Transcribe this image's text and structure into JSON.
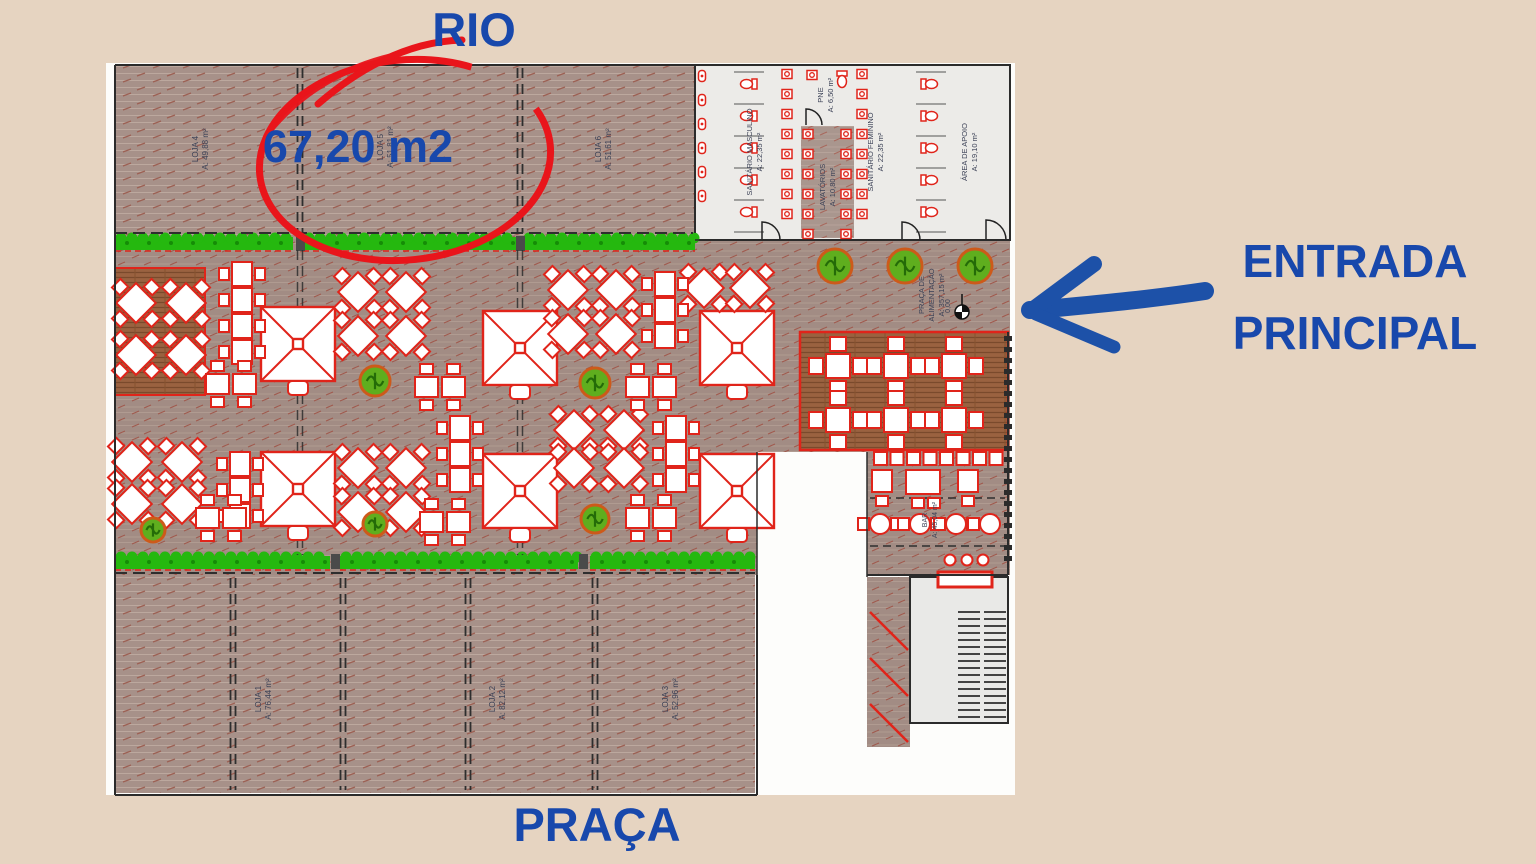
{
  "colors": {
    "background": "#e6d4c1",
    "annotation_blue": "#1848ac",
    "marker_red": "#e9151b",
    "furniture_red": "#e0241a",
    "hedge_green": "#25b80f",
    "wall": "#2b2b2b"
  },
  "annotations": {
    "rio": "RIO",
    "area_value": "67,20 m2",
    "entrada_line1": "ENTRADA",
    "entrada_line2": "PRINCIPAL",
    "praca": "PRAÇA"
  },
  "plan": {
    "areas": [
      {
        "id": "loja4",
        "lines": [
          "LOJA 4",
          "A: 49,88 m²"
        ],
        "x": 203,
        "y": 149,
        "fs": 8
      },
      {
        "id": "loja5",
        "lines": [
          "LOJA 5",
          "A: 51,81 m²"
        ],
        "x": 388,
        "y": 147,
        "fs": 8
      },
      {
        "id": "loja6",
        "lines": [
          "LOJA 6",
          "A: 51,61 m²"
        ],
        "x": 606,
        "y": 149,
        "fs": 8
      },
      {
        "id": "loja1",
        "lines": [
          "LOJA 1",
          "A: 76,44 m²"
        ],
        "x": 266,
        "y": 699,
        "fs": 8
      },
      {
        "id": "loja2",
        "lines": [
          "LOJA 2",
          "A: 82,12 m²"
        ],
        "x": 500,
        "y": 699,
        "fs": 8
      },
      {
        "id": "loja3",
        "lines": [
          "LOJA 3",
          "A: 52,96 m²"
        ],
        "x": 673,
        "y": 699,
        "fs": 8
      },
      {
        "id": "sanitario-masculino",
        "lines": [
          "SANITÁRIO MASCULINO",
          "A: 22,35 m²"
        ],
        "x": 757,
        "y": 152,
        "fs": 7.5
      },
      {
        "id": "pne",
        "lines": [
          "PNE",
          "A: 6,50 m²"
        ],
        "x": 828,
        "y": 95,
        "fs": 7.5
      },
      {
        "id": "lavatorios",
        "lines": [
          "LAVATÓRIOS",
          "A: 10,80 m²"
        ],
        "x": 830,
        "y": 187,
        "fs": 7.5
      },
      {
        "id": "sanitario-feminino",
        "lines": [
          "SANITÁRIO FEMININO",
          "A: 22,35 m²"
        ],
        "x": 878,
        "y": 152,
        "fs": 7.5
      },
      {
        "id": "area-de-apoio",
        "lines": [
          "ÁREA DE APOIO",
          "A: 19,10 m²"
        ],
        "x": 972,
        "y": 152,
        "fs": 7.5
      },
      {
        "id": "praca-alimentacao",
        "lines": [
          "PRAÇA DE",
          "ALIMENTAÇÃO",
          "A: 357,15 m²"
        ],
        "x": 934,
        "y": 295,
        "fs": 7.5
      },
      {
        "id": "bar",
        "lines": [
          "BAR",
          "A: 45,04 m²"
        ],
        "x": 932,
        "y": 520,
        "fs": 7
      }
    ],
    "level_marker": {
      "x": 962,
      "y": 312,
      "label": "0,00"
    },
    "furniture": {
      "umbrellas": [
        [
          298,
          344
        ],
        [
          520,
          348
        ],
        [
          737,
          348
        ],
        [
          298,
          489
        ],
        [
          520,
          491
        ],
        [
          737,
          491
        ]
      ],
      "diamond_tables": [
        [
          136,
          303
        ],
        [
          186,
          303
        ],
        [
          136,
          355
        ],
        [
          186,
          355
        ],
        [
          358,
          292
        ],
        [
          406,
          292
        ],
        [
          358,
          336
        ],
        [
          406,
          336
        ],
        [
          568,
          290
        ],
        [
          616,
          290
        ],
        [
          568,
          334
        ],
        [
          616,
          334
        ],
        [
          704,
          288
        ],
        [
          750,
          288
        ],
        [
          132,
          462
        ],
        [
          182,
          462
        ],
        [
          132,
          504
        ],
        [
          182,
          504
        ],
        [
          358,
          468
        ],
        [
          406,
          468
        ],
        [
          358,
          512
        ],
        [
          406,
          512
        ],
        [
          574,
          430
        ],
        [
          624,
          430
        ],
        [
          574,
          468
        ],
        [
          624,
          468
        ]
      ],
      "table_stacks": [
        [
          242,
          262,
          4
        ],
        [
          665,
          272,
          3
        ],
        [
          240,
          452,
          3
        ],
        [
          460,
          416,
          3
        ],
        [
          676,
          416,
          3
        ]
      ],
      "table_rows": [
        [
          206,
          384,
          2
        ],
        [
          415,
          387,
          2
        ],
        [
          626,
          387,
          2
        ],
        [
          420,
          522,
          2
        ],
        [
          626,
          518,
          2
        ],
        [
          196,
          518,
          2
        ]
      ],
      "cross_tables": [
        [
          838,
          366
        ],
        [
          896,
          366
        ],
        [
          954,
          366
        ],
        [
          838,
          420
        ],
        [
          896,
          420
        ],
        [
          954,
          420
        ]
      ],
      "trees": [
        [
          835,
          266,
          17
        ],
        [
          905,
          266,
          17
        ],
        [
          975,
          266,
          17
        ],
        [
          375,
          381,
          15
        ],
        [
          595,
          383,
          15
        ],
        [
          375,
          524,
          12
        ],
        [
          595,
          519,
          14
        ],
        [
          153,
          530,
          12
        ]
      ],
      "hedges_top": [
        [
          115,
          178
        ],
        [
          303,
          213
        ],
        [
          523,
          172
        ]
      ],
      "hedges_bottom": [
        [
          115,
          215
        ],
        [
          340,
          238
        ],
        [
          590,
          165
        ]
      ],
      "bar_counter_squares": 8,
      "bar_round_tables": [
        [
          880,
          524
        ],
        [
          920,
          524
        ],
        [
          956,
          524
        ],
        [
          990,
          524
        ]
      ],
      "bar_stools": [
        [
          950,
          560
        ],
        [
          967,
          560
        ],
        [
          983,
          560
        ]
      ]
    }
  }
}
